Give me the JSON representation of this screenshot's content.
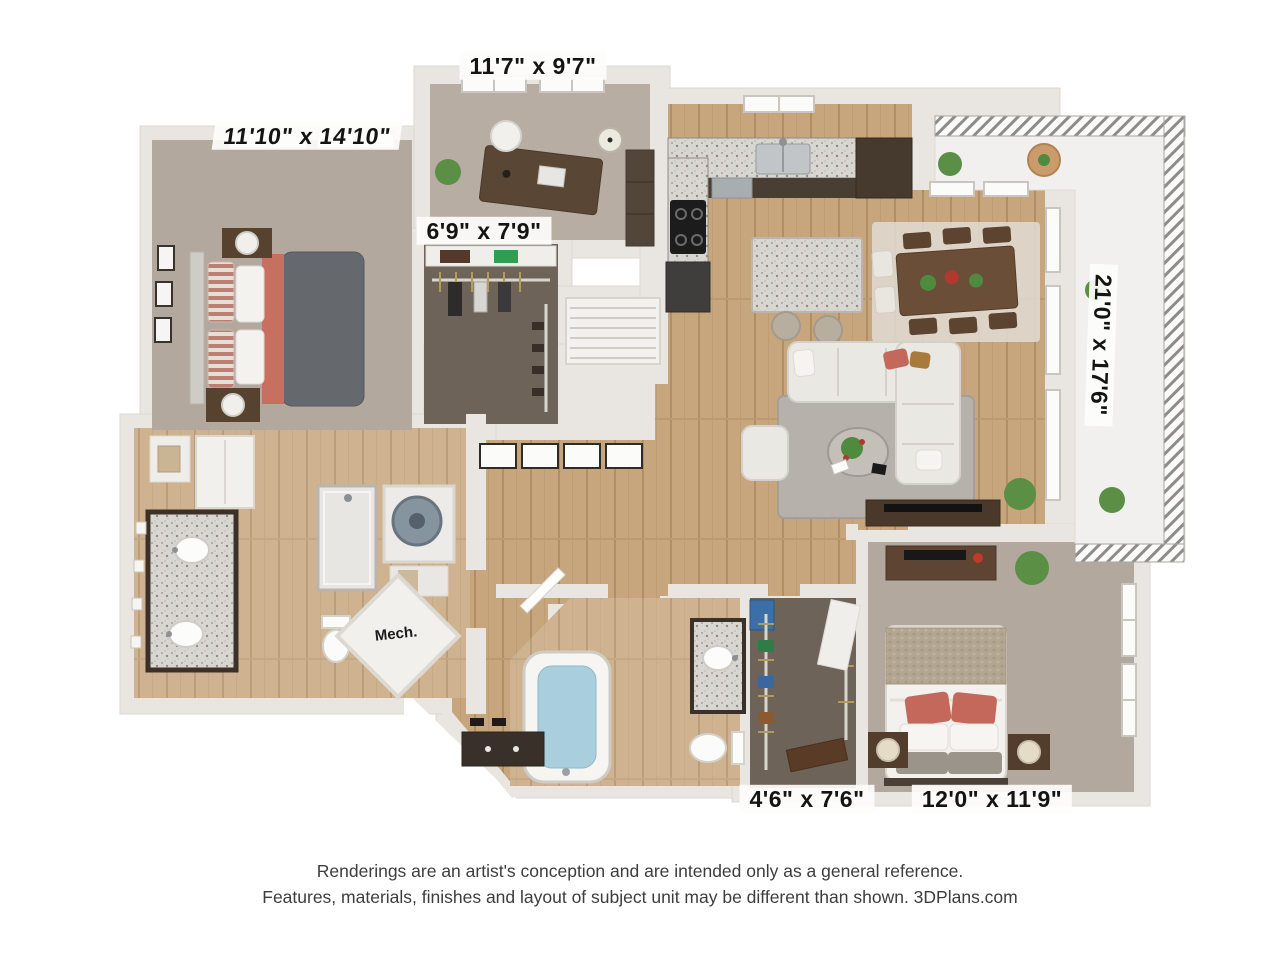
{
  "plan": {
    "type": "apartment-floor-plan-3d",
    "dimension_labels": {
      "office": "11'7\" x 9'7\"",
      "master_bedroom": "11'10\" x 14'10\"",
      "walk_in_closet": "6'9\" x 7'9\"",
      "living_area": "21'0\" x 17'6\"",
      "second_bath": "4'6\" x 7'6\"",
      "second_bedroom": "12'0\" x 11'9\"",
      "mech_room": "Mech."
    },
    "rooms": [
      {
        "name": "master-bedroom",
        "dimensions": "11'10\" x 14'10\""
      },
      {
        "name": "office-den",
        "dimensions": "11'7\" x 9'7\""
      },
      {
        "name": "walk-in-closet",
        "dimensions": "6'9\" x 7'9\""
      },
      {
        "name": "living-dining-kitchen",
        "dimensions": "21'0\" x 17'6\""
      },
      {
        "name": "second-bath",
        "dimensions": "4'6\" x 7'6\""
      },
      {
        "name": "second-bedroom",
        "dimensions": "12'0\" x 11'9\""
      },
      {
        "name": "mechanical-closet",
        "dimensions": "Mech."
      }
    ],
    "colors": {
      "wall": "#e9e6e1",
      "wood_floor": "#c7a67d",
      "carpet": "#b3a89e",
      "dark_closet_carpet": "#6e6358",
      "cabinet_dark": "#493e33",
      "granite": "#d8d6d1",
      "accent_red": "#c4685c",
      "sofa_cream": "#eae8e3",
      "plant_green": "#5b8f45",
      "tub_water": "#a9cfdf"
    }
  },
  "footer": {
    "line1": "Renderings are an artist's conception and are intended only as a general reference.",
    "line2": "Features, materials, finishes and layout of subject unit may be different than shown. 3DPlans.com"
  }
}
